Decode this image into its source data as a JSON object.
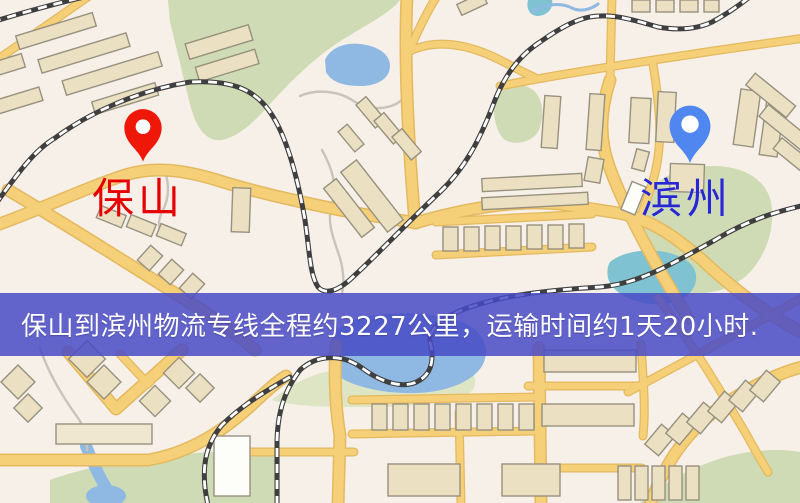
{
  "map": {
    "origin": {
      "label": "保山",
      "pin_color": "#ee1708",
      "label_color": "#e60000"
    },
    "destination": {
      "label": "滨州",
      "pin_color": "#4f86ef",
      "label_color": "#2727d4"
    },
    "banner": {
      "text": "保山到滨州物流专线全程约3227公里，运输时间约1天20小时.",
      "bg_color": "rgba(72,74,198,0.85)",
      "text_color": "#ffffff"
    },
    "palette": {
      "land": "#f7f0e8",
      "road": "#f5d078",
      "road_casing": "#e4b95f",
      "green": "#cedbb4",
      "water": "#8fb9e3",
      "teal": "#7fc3d2",
      "railway": "#3f3f3f",
      "building": "#ebe0c2",
      "building_outline": "#97917f"
    }
  }
}
